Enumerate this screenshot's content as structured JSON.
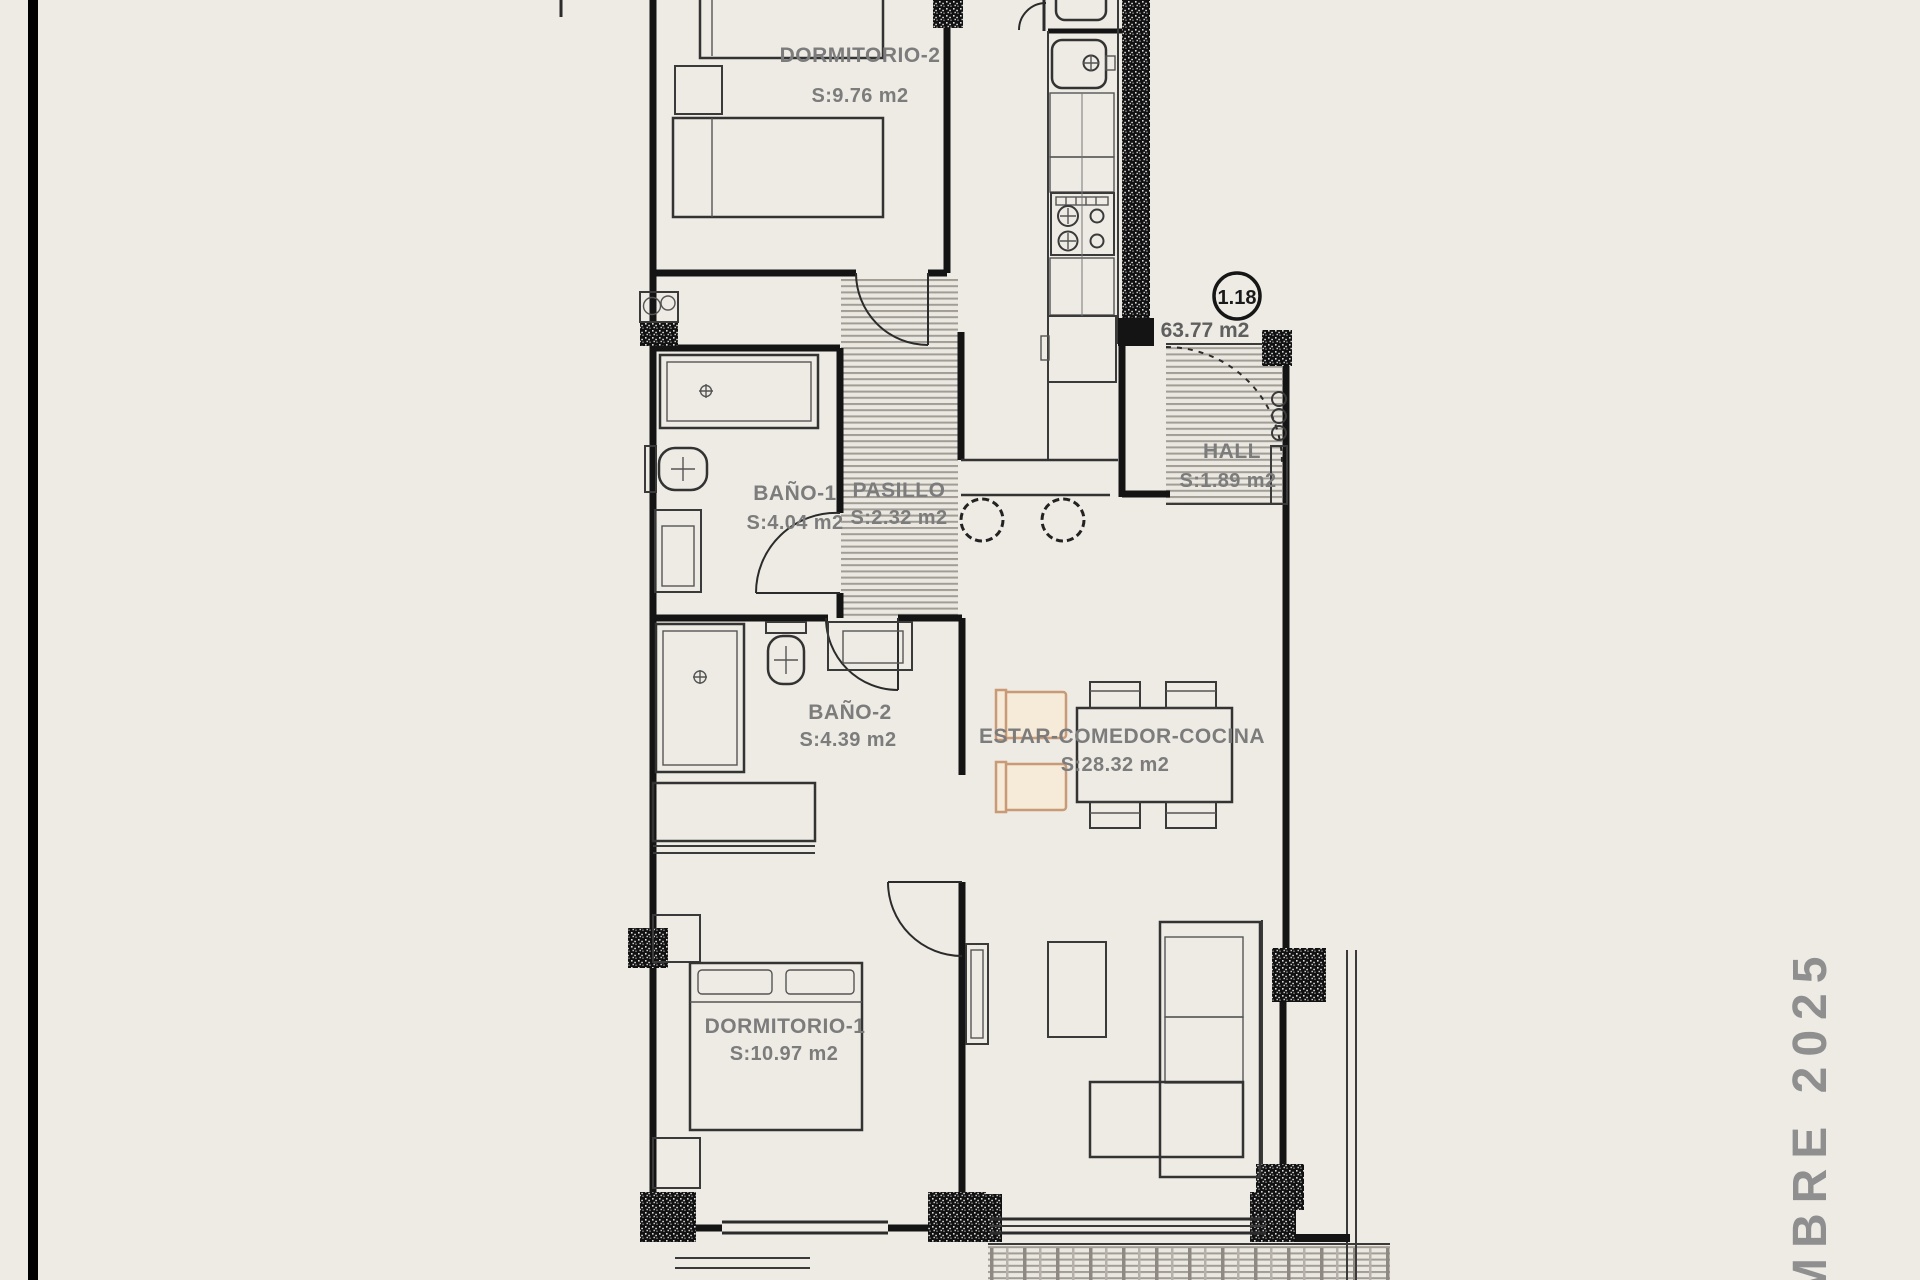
{
  "plan": {
    "unit_badge": "1.18",
    "total_area_label": "63.77 m2",
    "date_stamp_vertical": "MBRE 2025",
    "rooms": [
      {
        "name": "DORMITORIO-2",
        "area": "S:9.76 m2"
      },
      {
        "name": "BAÑO-1",
        "area": "S:4.04 m2"
      },
      {
        "name": "PASILLO",
        "area": "S:2.32 m2"
      },
      {
        "name": "HALL",
        "area": "S:1.89 m2"
      },
      {
        "name": "BAÑO-2",
        "area": "S:4.39 m2"
      },
      {
        "name": "ESTAR-COMEDOR-COCINA",
        "area": "S:28.32 m2"
      },
      {
        "name": "DORMITORIO-1",
        "area": "S:10.97 m2"
      }
    ]
  },
  "colors": {
    "background": "#eeebe5",
    "wall": "#141414",
    "label_gray": "#7c7c7c",
    "accent_tan": "#c89a76",
    "date_gray": "#8f8f8f"
  }
}
